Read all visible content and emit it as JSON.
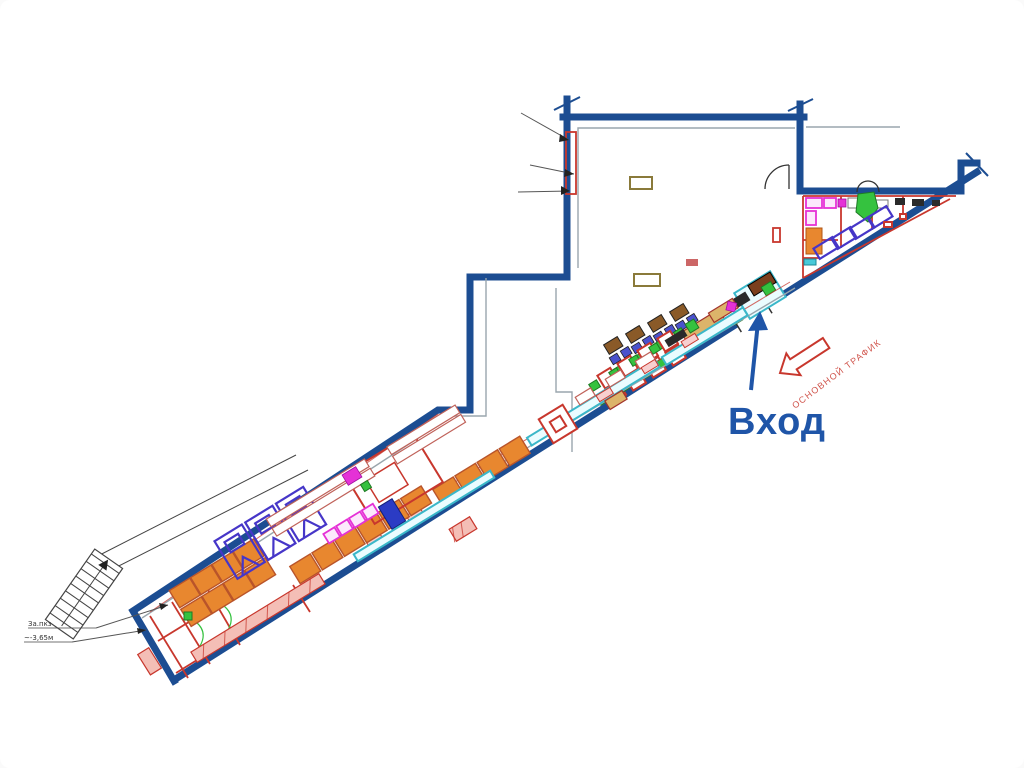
{
  "labels": {
    "entrance": "Вход",
    "main_traffic": "ОСНОВНОЙ ТРАФИК",
    "stair_note_1": "За.пкз",
    "stair_note_2": "~-3,65м"
  },
  "colors": {
    "wall_blue": "#1c4d92",
    "entrance_blue": "#1f55a8",
    "partition_red": "#c8372d",
    "inner_gray": "#9aa6ad",
    "locker_orange": "#e8872f",
    "chair_green": "#35c23f",
    "counter_cyan": "#3ab7c9",
    "stall_indigo": "#4636c8",
    "fixture_magenta": "#e531d6",
    "table_brown": "#8a5a28",
    "counter_tan": "#dcb46a",
    "background": "#ffffff"
  }
}
